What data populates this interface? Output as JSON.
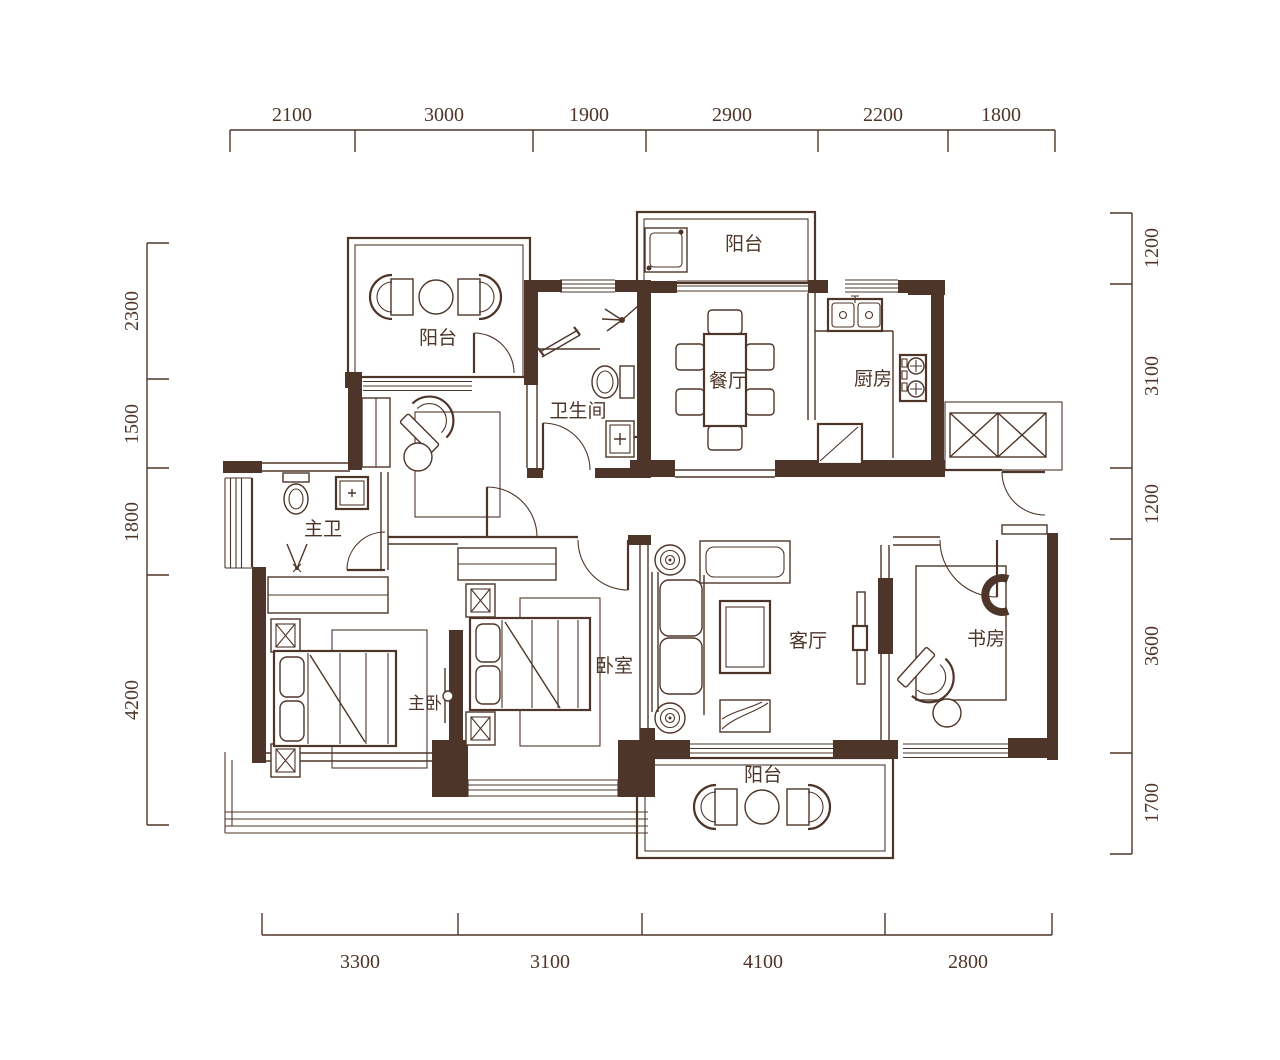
{
  "drawing": {
    "type": "apartment-floor-plan",
    "ink_color": "#4e3529",
    "background_color": "#ffffff"
  },
  "rooms": {
    "balcony_top_left": "阳台",
    "balcony_top": "阳台",
    "bathroom": "卫生间",
    "dining": "餐厅",
    "kitchen": "厨房",
    "master_bath": "主卫",
    "master_bedroom": "主卧",
    "bedroom": "卧室",
    "living": "客厅",
    "study": "书房",
    "balcony_bottom": "阳台"
  },
  "dimensions_mm": {
    "top": [
      "2100",
      "3000",
      "1900",
      "2900",
      "2200",
      "1800"
    ],
    "bottom": [
      "3300",
      "3100",
      "4100",
      "2800"
    ],
    "left": [
      "2300",
      "1500",
      "1800",
      "4200"
    ],
    "right": [
      "1200",
      "3100",
      "1200",
      "3600",
      "1700"
    ]
  }
}
